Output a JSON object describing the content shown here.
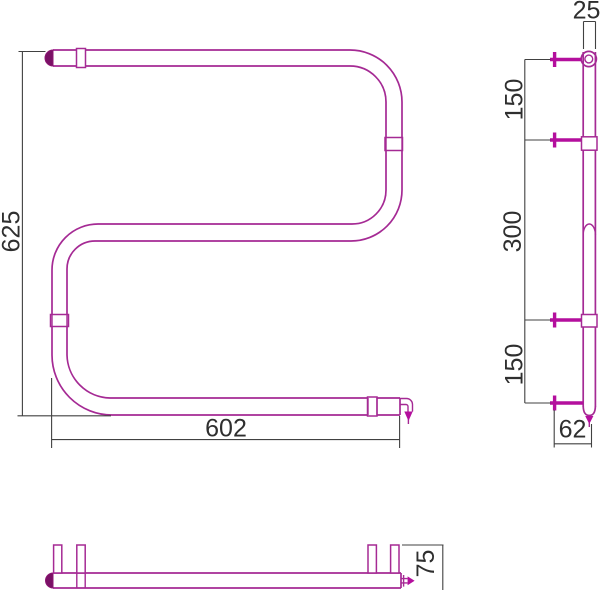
{
  "drawing": {
    "colors": {
      "pipe_outline": "#a52a94",
      "pipe_bold": "#b40f9d",
      "pipe_dark_fill": "#7a1166",
      "dimension_lines": "#414141",
      "dimension_text": "#2f2f2f",
      "background": "#ffffff"
    },
    "front_view": {
      "height": "625",
      "width": "602"
    },
    "side_view": {
      "diameter": "25",
      "spacing_top": "150",
      "spacing_middle": "300",
      "spacing_bottom": "150",
      "offset_bottom": "62"
    },
    "bottom_view": {
      "depth": "75"
    }
  }
}
